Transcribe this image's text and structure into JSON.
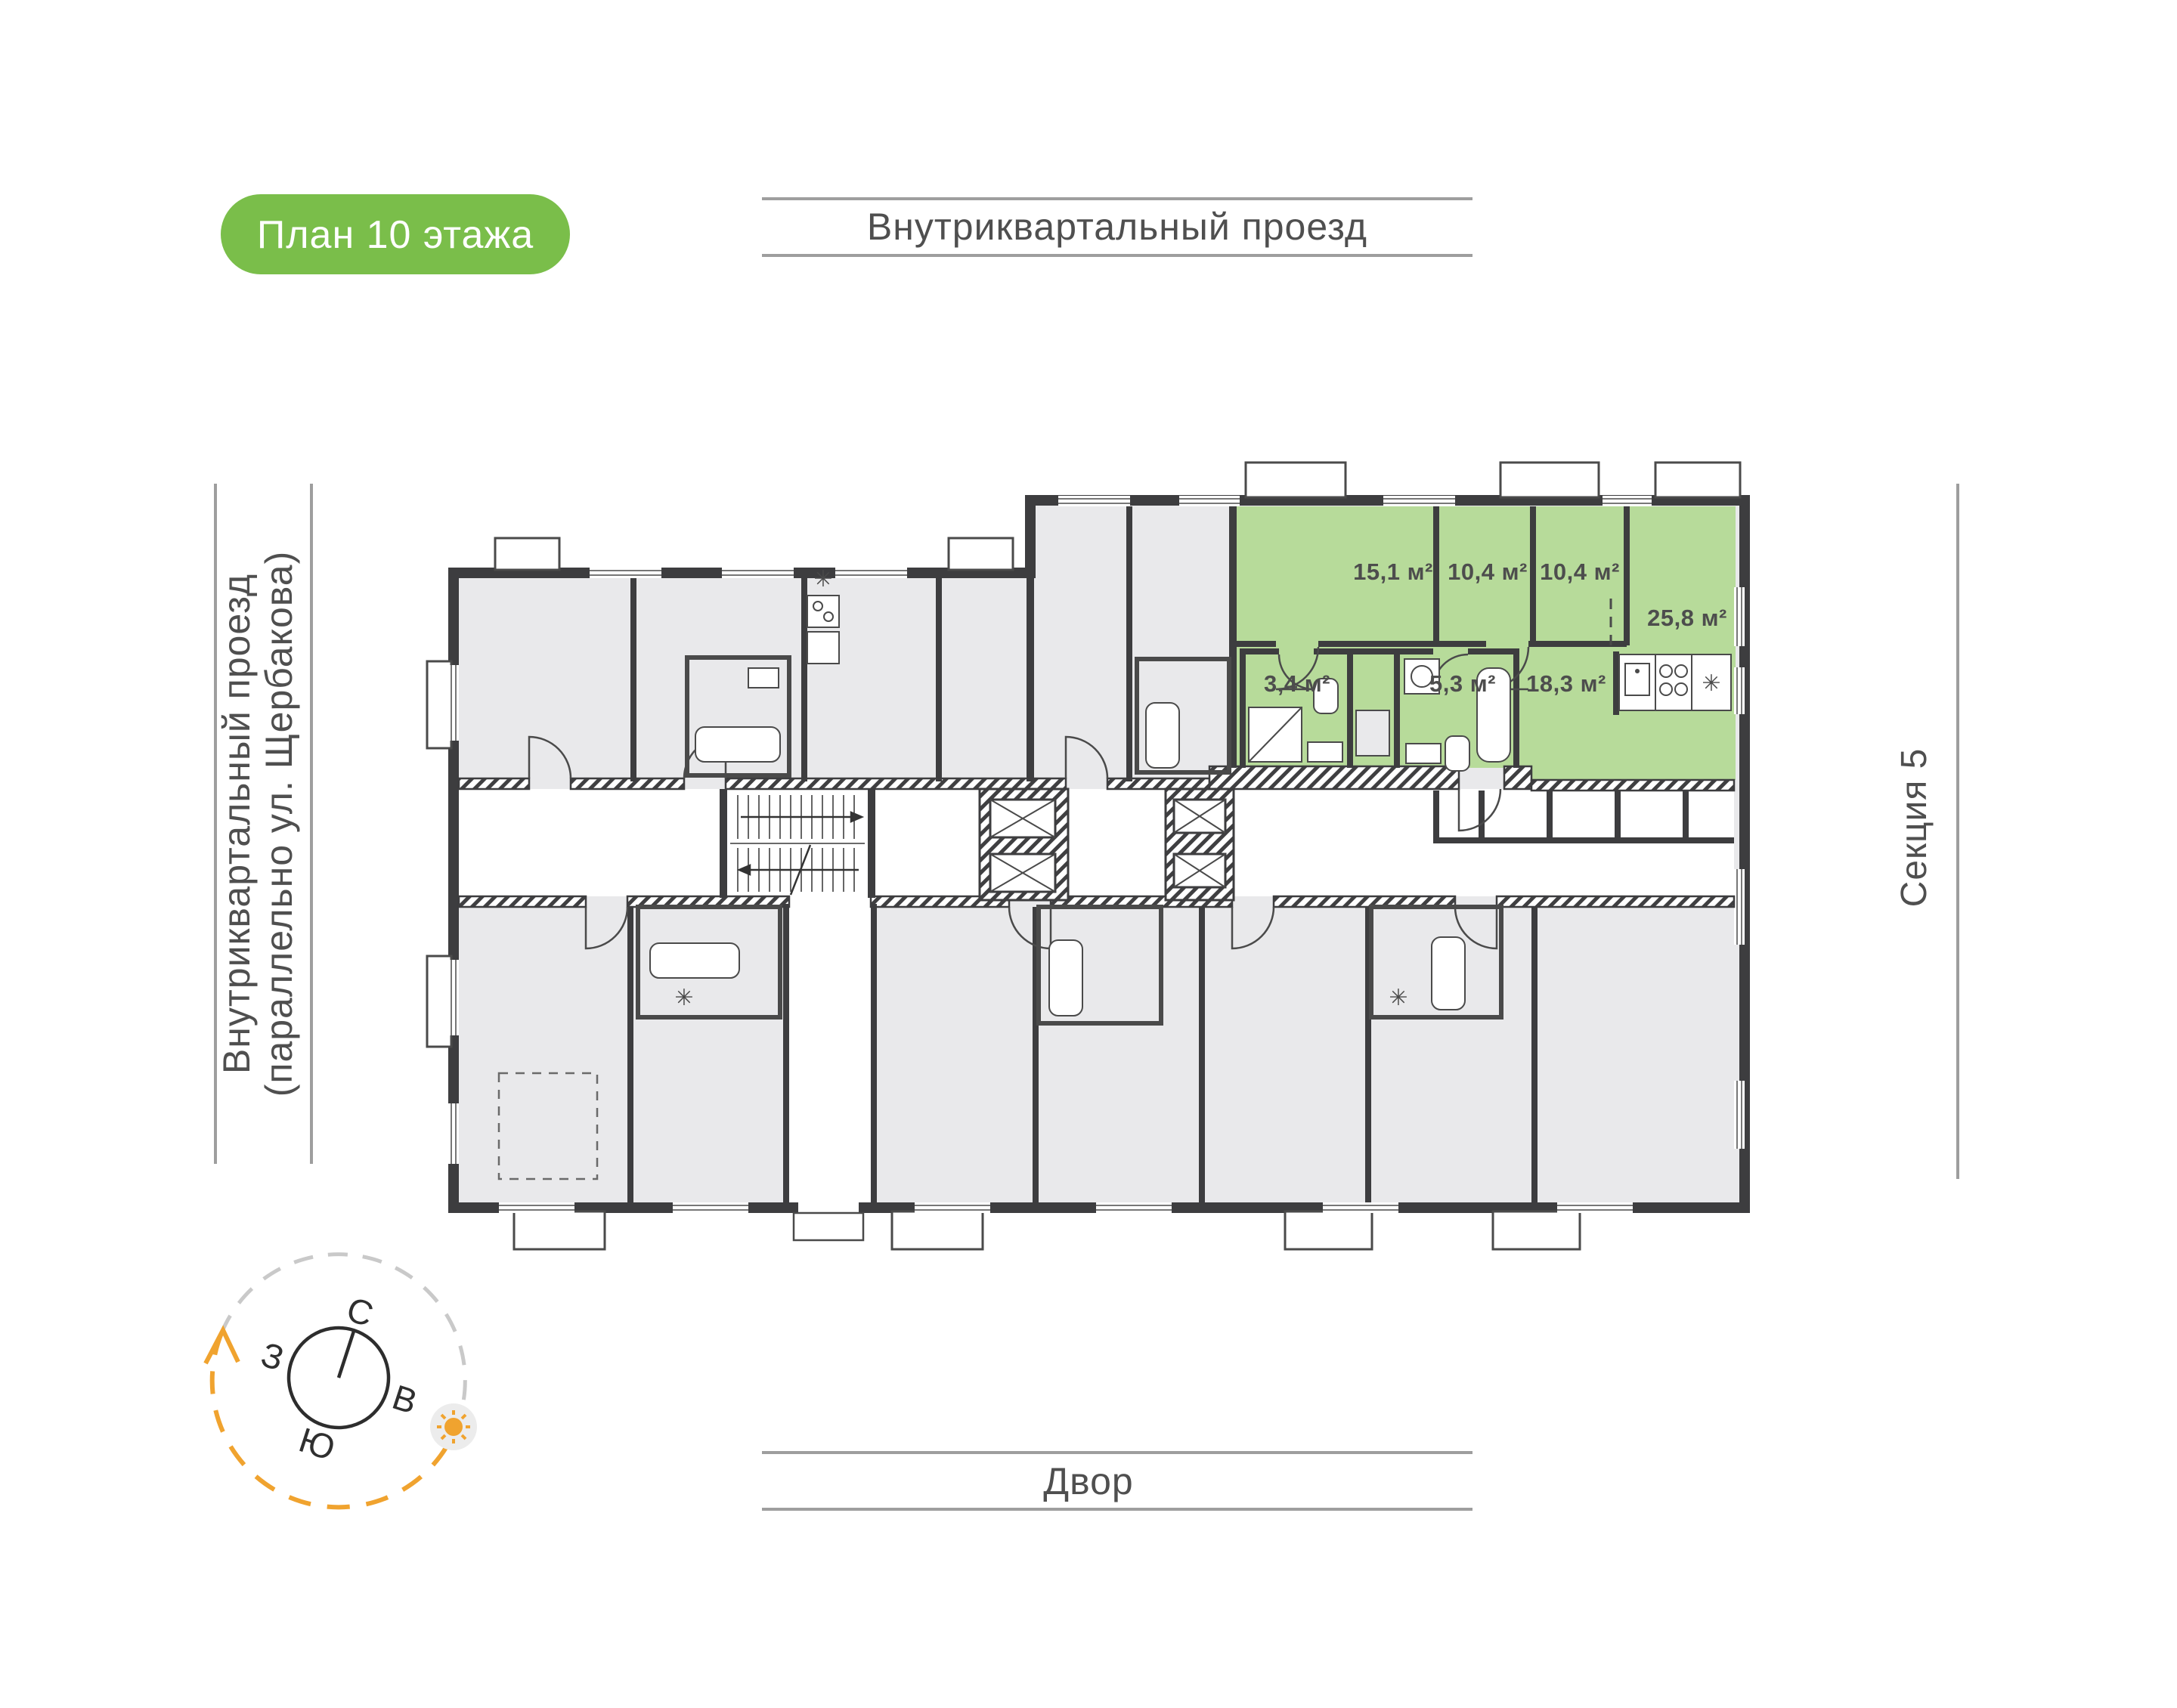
{
  "page": {
    "background": "#ffffff"
  },
  "badge": {
    "label": "План 10 этажа",
    "bg_color": "#7abe4a",
    "text_color": "#ffffff"
  },
  "roads": {
    "top": "Внутриквартальный проезд",
    "left_line1": "Внутриквартальный проезд",
    "left_line2": "(параллельно ул. Щербакова)",
    "bottom": "Двор",
    "section": "Секция 5"
  },
  "compass": {
    "north": "С",
    "east": "В",
    "south": "Ю",
    "west": "З",
    "sun_color": "#f0a32f"
  },
  "apartment": {
    "highlight_color": "#b7db9a",
    "rooms": [
      {
        "name": "bedroom-1",
        "area": "15,1 м²"
      },
      {
        "name": "bedroom-2",
        "area": "10,4 м²"
      },
      {
        "name": "bedroom-3",
        "area": "10,4 м²"
      },
      {
        "name": "living-kitchen",
        "area": "25,8 м²"
      },
      {
        "name": "bathroom-small",
        "area": "3,4 м²"
      },
      {
        "name": "bathroom",
        "area": "5,3 м²"
      },
      {
        "name": "hall",
        "area": "18,3 м²"
      }
    ]
  },
  "plan": {
    "fridge_symbol": "✳",
    "wall_color": "#3d3d3f",
    "unit_fill": "#e9e9eb",
    "road_line_color": "#9e9e9e"
  }
}
